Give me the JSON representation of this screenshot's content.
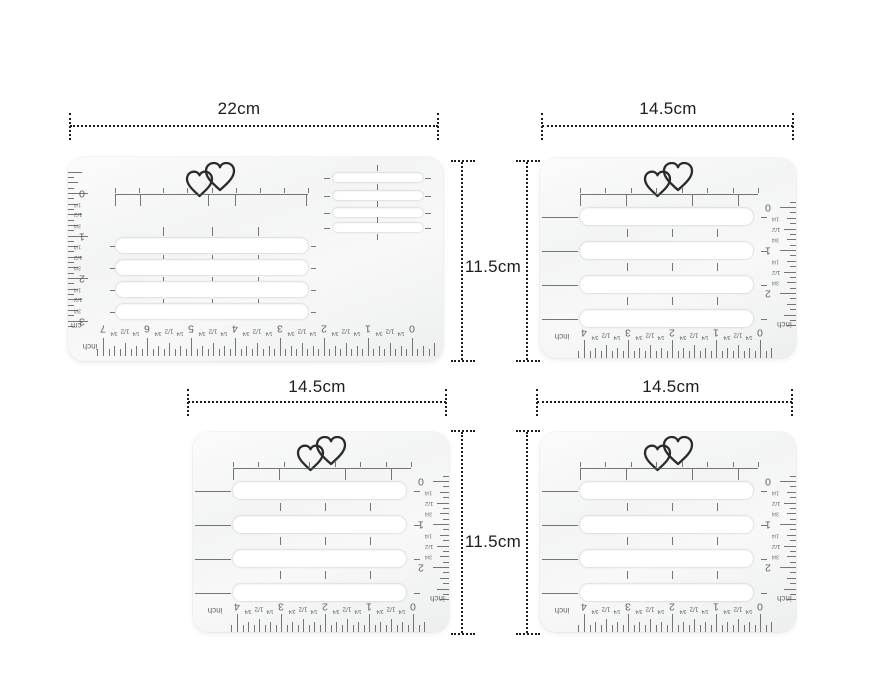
{
  "colors": {
    "background": "#ffffff",
    "dimension_ink": "#1d1d1d",
    "stencil_ink": "#555555",
    "heart_ink": "#2b2b2b",
    "stencil_body": "#f5f6f6",
    "slot_fill": "#ffffff"
  },
  "annotations": {
    "large_width": "22cm",
    "top_right_width": "14.5cm",
    "bottom_left_width": "14.5cm",
    "bottom_right_width": "14.5cm",
    "row1_height": "11.5cm",
    "row2_height": "11.5cm"
  },
  "rulers": {
    "inch_unit": "inch",
    "cm_unit": "cm",
    "quarter": "1/4",
    "half": "1/2",
    "three_quarter": "3/4",
    "large_bottom_numbers": [
      "7",
      "6",
      "5",
      "4",
      "3",
      "2",
      "1",
      "0"
    ],
    "large_side_numbers": [
      "0",
      "1",
      "2",
      "3"
    ],
    "small_bottom_numbers": [
      "4",
      "3",
      "2",
      "1",
      "0"
    ],
    "small_side_numbers": [
      "0",
      "1",
      "2"
    ]
  },
  "icons": {
    "logo": "double-heart-icon"
  }
}
